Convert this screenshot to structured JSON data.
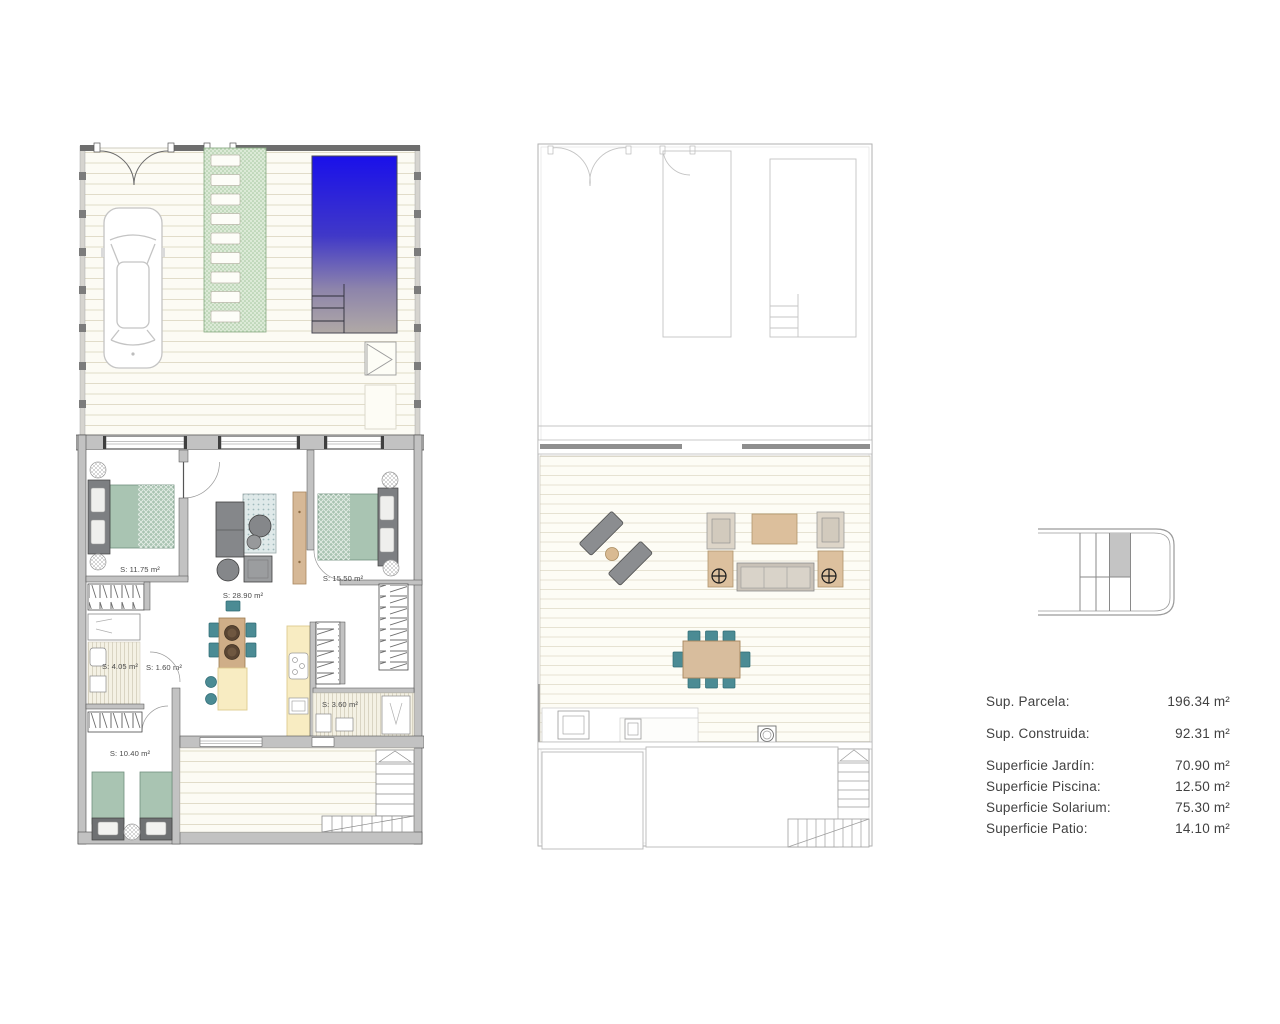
{
  "sheet": {
    "type": "real-estate floor plan sheet"
  },
  "ground_floor": {
    "rooms": [
      {
        "name": "bedroom-1",
        "label": "S: 11.75 m²"
      },
      {
        "name": "living-kitchen",
        "label": "S: 28.90 m²"
      },
      {
        "name": "bedroom-2",
        "label": "S: 15.50 m²"
      },
      {
        "name": "bathroom-1",
        "label": "S: 4.05 m²"
      },
      {
        "name": "hall",
        "label": "S: 1.60 m²"
      },
      {
        "name": "bathroom-2",
        "label": "S: 3.60 m²"
      },
      {
        "name": "bedroom-3",
        "label": "S: 10.40 m²"
      }
    ]
  },
  "areas": {
    "rows": [
      {
        "label": "Sup. Parcela:",
        "value": "196.34 m²"
      },
      {
        "label": "Sup. Construida:",
        "value": "92.31 m²"
      },
      {
        "label": "Superficie Jardín:",
        "value": "70.90 m²"
      },
      {
        "label": "Superficie Piscina:",
        "value": "12.50 m²"
      },
      {
        "label": "Superficie Solarium:",
        "value": "75.30 m²"
      },
      {
        "label": "Superficie Patio:",
        "value": "14.10 m²"
      }
    ]
  },
  "icons": [
    "car",
    "pool",
    "pool-steps",
    "outdoor-shower",
    "garden-path",
    "double-bed",
    "single-bed",
    "sofa",
    "rug",
    "dining-table",
    "kitchen-island",
    "cooktop",
    "sink",
    "wardrobe-hangers",
    "stairs-up",
    "sun-lounger",
    "parasol-table",
    "bbq",
    "location-key"
  ],
  "colors": {
    "pool_blue": "#1a10ea",
    "pool_fade": "#b0a9a6",
    "garden_green": "#dcead7",
    "deck_line": "#e1dcc9",
    "wall_gray": "#c2c2c2",
    "wall_dark": "#4a4a4a",
    "bed_sage": "#a9c4b2",
    "chair_teal": "#4b8b94",
    "counter_yellow": "#f8ecc2",
    "wood_tan": "#d8bd9d",
    "furniture_gray": "#85878a",
    "text": "#414141",
    "key_highlight": "#c4c4c4"
  }
}
